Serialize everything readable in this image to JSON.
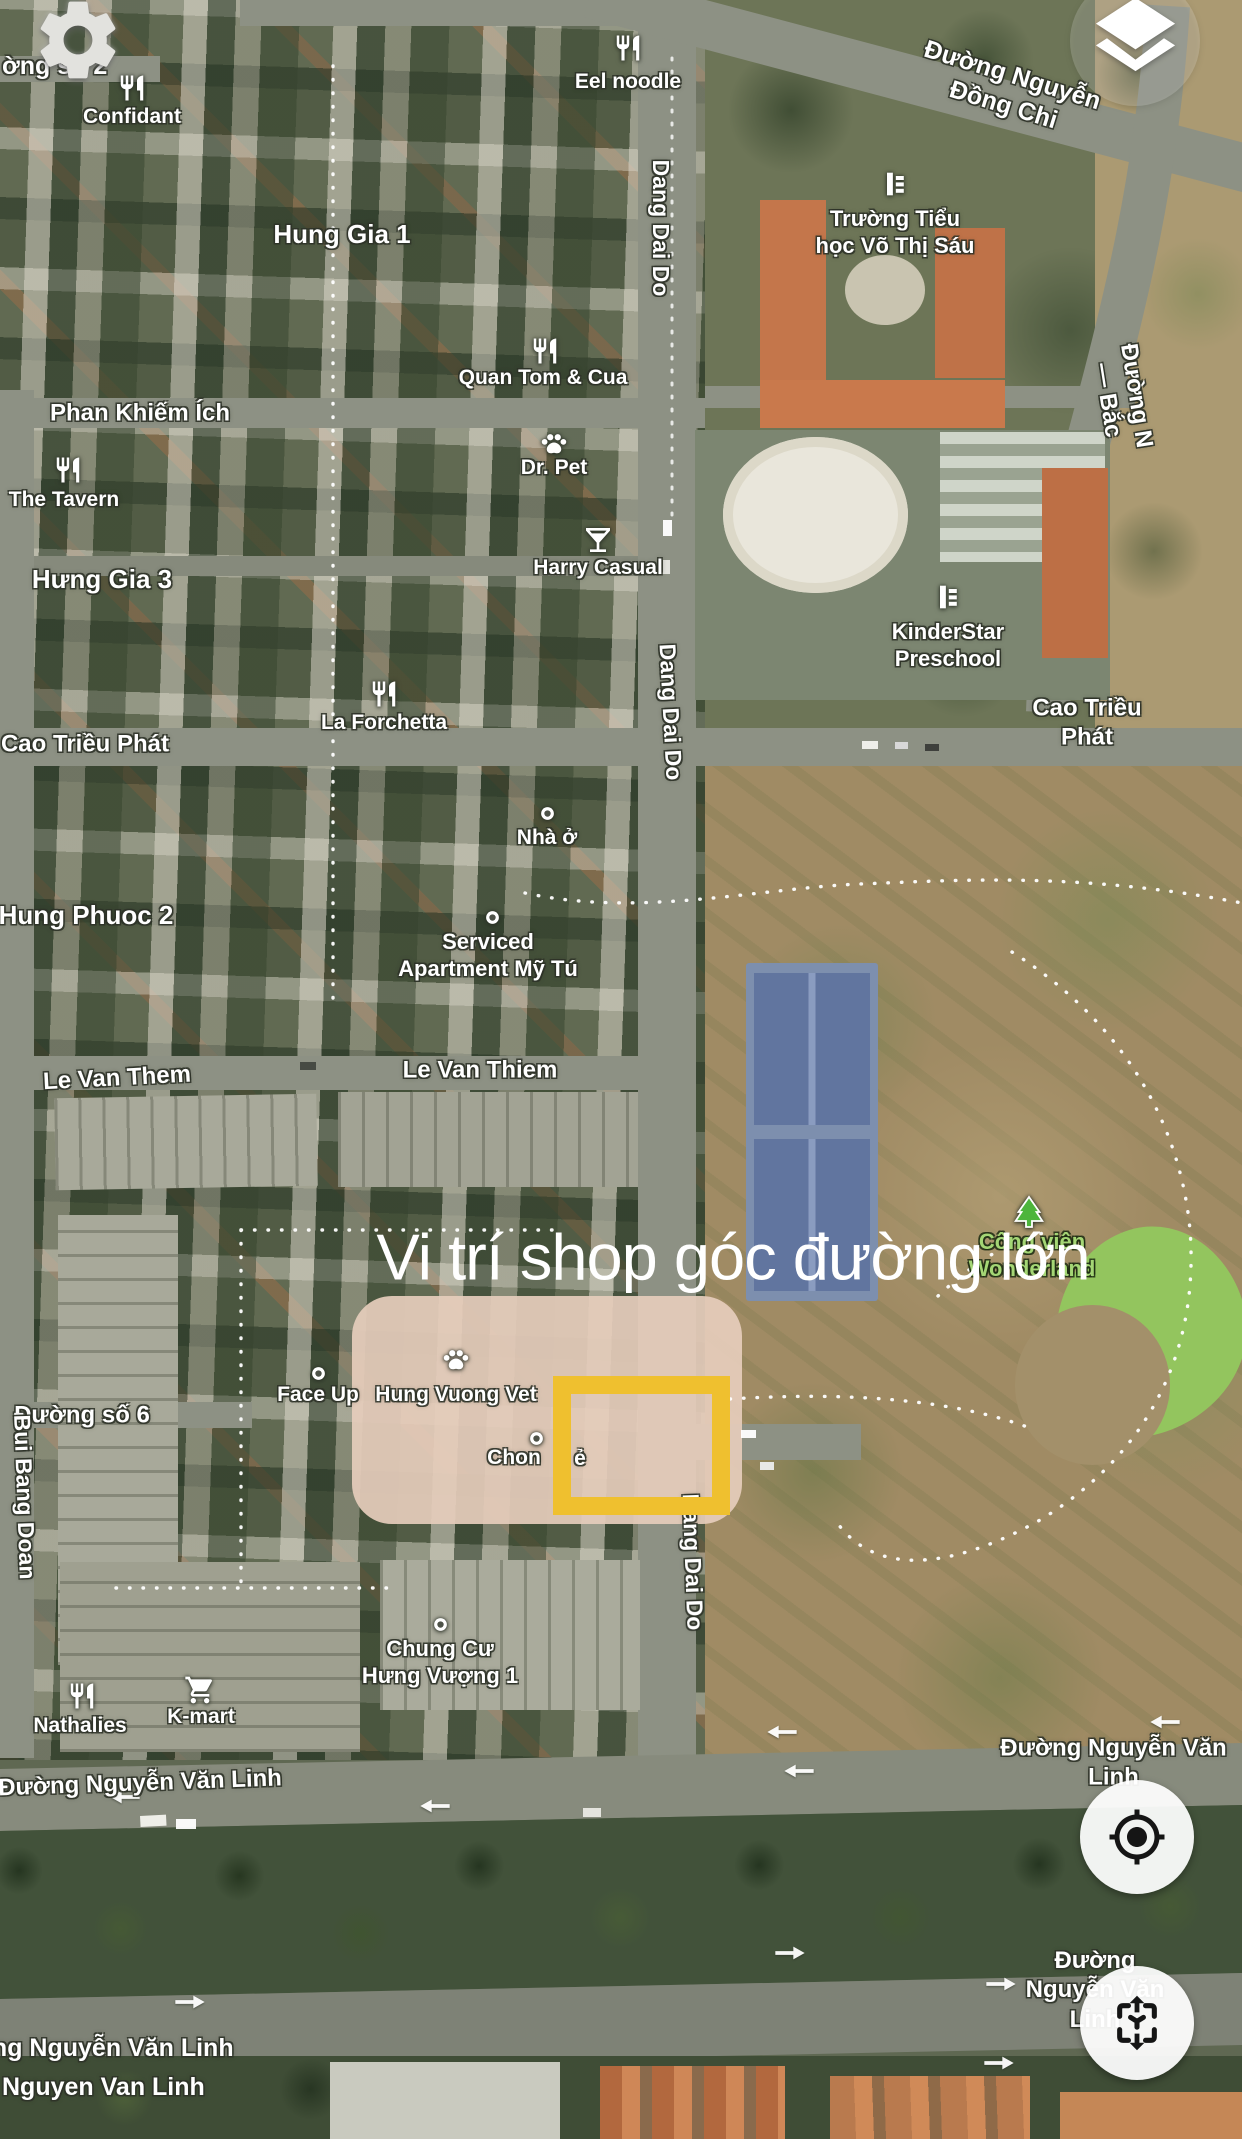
{
  "app": {
    "kind": "mobile-satellite-map"
  },
  "annotation": {
    "headline": "Vi trí shop góc đường lớn",
    "highlight_box_color": "#efc02f"
  },
  "controls": [
    {
      "name": "settings-button",
      "icon": "gear-icon"
    },
    {
      "name": "layers-button",
      "icon": "layers-icon"
    },
    {
      "name": "my-location-button",
      "icon": "locate-icon"
    },
    {
      "name": "spatial-view-button",
      "icon": "spatial-icon"
    }
  ],
  "colors": {
    "highlight": "#efc02f",
    "label_text": "#ffffff",
    "park_label_text": "#a4d675",
    "road": "#8d9184",
    "tennis_court": "#61759f",
    "park_lawn": "#93c55e"
  },
  "labels": [
    {
      "name": "street-duong-so-2",
      "kind": "street",
      "text": "ờng số 2",
      "x": 2,
      "y": 66,
      "size": 25,
      "ax": 0
    },
    {
      "name": "street-nguyen-dong-chi",
      "kind": "street",
      "text": "Đường Nguyễn Đồng Chi",
      "x": 1008,
      "y": 90,
      "rot": 17,
      "size": 25
    },
    {
      "name": "street-n-bac",
      "kind": "street",
      "text": "Đường N — Bắc",
      "x": 1122,
      "y": 398,
      "rot": 81,
      "size": 24
    },
    {
      "name": "street-dang-dai-do-top",
      "kind": "street",
      "text": "Dang Dai Do",
      "x": 661,
      "y": 228,
      "rot": 90,
      "size": 23
    },
    {
      "name": "street-dang-dai-do-mid",
      "kind": "street",
      "text": "Dang Dai Do",
      "x": 671,
      "y": 712,
      "rot": 87,
      "size": 23
    },
    {
      "name": "street-dang-dai-do-south",
      "kind": "street",
      "text": "Dang Dai Do",
      "x": 693,
      "y": 1562,
      "rot": 88,
      "size": 23
    },
    {
      "name": "street-phan-khiem-ich",
      "kind": "street",
      "text": "Phan Khiếm Ích",
      "x": 140,
      "y": 413,
      "size": 24
    },
    {
      "name": "street-cao-trieu-phat-west",
      "kind": "street",
      "text": "Cao Triều Phát",
      "x": 85,
      "y": 744,
      "size": 24
    },
    {
      "name": "street-cao-trieu-phat-east",
      "kind": "street",
      "text": "Cao Triều Phát",
      "x": 1087,
      "y": 723,
      "size": 24
    },
    {
      "name": "street-le-van-them",
      "kind": "street",
      "text": "Le Van Them",
      "x": 117,
      "y": 1078,
      "rot": -3,
      "size": 24
    },
    {
      "name": "street-le-van-thiem",
      "kind": "street",
      "text": "Le Van Thiem",
      "x": 480,
      "y": 1070,
      "size": 24
    },
    {
      "name": "street-duong-so-6",
      "kind": "street",
      "text": "Đường số 6",
      "x": 82,
      "y": 1415,
      "size": 24
    },
    {
      "name": "street-bui-bang-doan",
      "kind": "street",
      "text": "Bui Bang Doan",
      "x": 25,
      "y": 1497,
      "rot": 88,
      "size": 23
    },
    {
      "name": "street-nguyen-van-linh-west",
      "kind": "street",
      "text": "Đường Nguyễn Văn Linh",
      "x": 140,
      "y": 1783,
      "rot": -2,
      "size": 24
    },
    {
      "name": "street-nguyen-van-linh-east",
      "kind": "street",
      "text": "Đường Nguyễn Văn Linh",
      "x": 985,
      "y": 1763,
      "size": 24,
      "ax": 0
    },
    {
      "name": "street-nguyen-van-linh-southeast",
      "kind": "street",
      "text": "Đường Nguyễn Văn Linh",
      "x": 1095,
      "y": 1990,
      "size": 24
    },
    {
      "name": "street-nguyen-van-linh-southwest",
      "kind": "street",
      "text": "Đường Nguyễn Văn Linh",
      "x": -62,
      "y": 2048,
      "size": 25,
      "ax": 0
    },
    {
      "name": "street-nguyen-van-linh-plain",
      "kind": "street",
      "text": "Nguyen Van Linh",
      "x": 2,
      "y": 2087,
      "size": 25,
      "ax": 0
    },
    {
      "name": "area-hung-gia-1",
      "kind": "area",
      "text": "Hung Gia 1",
      "x": 342,
      "y": 235,
      "size": 26
    },
    {
      "name": "area-hung-gia-3",
      "kind": "area",
      "text": "Hưng Gia 3",
      "x": 102,
      "y": 580,
      "size": 26
    },
    {
      "name": "area-hung-phuoc-2",
      "kind": "area",
      "text": "Hung Phuoc 2",
      "x": 86,
      "y": 916,
      "size": 26
    },
    {
      "name": "poi-confidant",
      "kind": "poi",
      "text": "Confidant",
      "x": 132,
      "y": 117,
      "size": 21
    },
    {
      "name": "poi-eel-noodle",
      "kind": "poi",
      "text": "Eel noodle",
      "x": 628,
      "y": 82,
      "size": 21
    },
    {
      "name": "poi-truong-tieu-hoc-vo-thi-sau",
      "kind": "poi",
      "text": "Trường Tiểu\nhọc Võ Thị Sáu",
      "x": 895,
      "y": 233,
      "size": 22
    },
    {
      "name": "poi-quan-tom-cua",
      "kind": "poi",
      "text": "Quan Tom & Cua",
      "x": 543,
      "y": 378,
      "size": 21
    },
    {
      "name": "poi-dr-pet",
      "kind": "poi",
      "text": "Dr. Pet",
      "x": 554,
      "y": 468,
      "size": 21
    },
    {
      "name": "poi-the-tavern",
      "kind": "poi",
      "text": "The Tavern",
      "x": 64,
      "y": 500,
      "size": 21
    },
    {
      "name": "poi-harry-casual",
      "kind": "poi",
      "text": "Harry Casual",
      "x": 598,
      "y": 568,
      "size": 21
    },
    {
      "name": "poi-kinderstar-preschool",
      "kind": "poi",
      "text": "KinderStar\nPreschool",
      "x": 948,
      "y": 646,
      "size": 22
    },
    {
      "name": "poi-la-forchetta",
      "kind": "poi",
      "text": "La Forchetta",
      "x": 384,
      "y": 723,
      "size": 21
    },
    {
      "name": "poi-nha-o",
      "kind": "poi",
      "text": "Nhà ở",
      "x": 547,
      "y": 838,
      "size": 21
    },
    {
      "name": "poi-serviced-apartment-my-tu",
      "kind": "poi",
      "text": "Serviced\nApartment Mỹ Tú",
      "x": 488,
      "y": 956,
      "size": 22
    },
    {
      "name": "poi-face-up",
      "kind": "poi",
      "text": "Face Up",
      "x": 318,
      "y": 1395,
      "size": 21
    },
    {
      "name": "poi-hung-vuong-vet",
      "kind": "poi",
      "text": "Hung Vuong Vet",
      "x": 456,
      "y": 1395,
      "size": 21
    },
    {
      "name": "poi-chon",
      "kind": "poi",
      "text": "Chon",
      "x": 514,
      "y": 1458,
      "size": 21
    },
    {
      "name": "poi-chon-fragment",
      "kind": "poi",
      "text": "ẻ",
      "x": 580,
      "y": 1459,
      "size": 21
    },
    {
      "name": "poi-chung-cu-hung-vuong-1",
      "kind": "poi",
      "text": "Chung Cư\nHưng Vượng 1",
      "x": 440,
      "y": 1663,
      "size": 22
    },
    {
      "name": "poi-nathalies",
      "kind": "poi",
      "text": "Nathalies",
      "x": 80,
      "y": 1726,
      "size": 21
    },
    {
      "name": "poi-k-mart",
      "kind": "poi",
      "text": "K-mart",
      "x": 201,
      "y": 1717,
      "size": 21
    },
    {
      "name": "poi-cong-vien-wonderland",
      "kind": "park",
      "text": "Công viên\nWonderland",
      "x": 1032,
      "y": 1256,
      "size": 22
    }
  ],
  "icons": [
    {
      "name": "restaurant-icon",
      "glyph": "i-fork",
      "x": 132,
      "y": 88,
      "size": 30
    },
    {
      "name": "restaurant-icon",
      "glyph": "i-fork",
      "x": 628,
      "y": 48,
      "size": 30
    },
    {
      "name": "restaurant-icon",
      "glyph": "i-fork",
      "x": 68,
      "y": 470,
      "size": 30
    },
    {
      "name": "restaurant-icon",
      "glyph": "i-fork",
      "x": 545,
      "y": 351,
      "size": 30
    },
    {
      "name": "restaurant-icon",
      "glyph": "i-fork",
      "x": 384,
      "y": 694,
      "size": 30
    },
    {
      "name": "restaurant-icon",
      "glyph": "i-fork",
      "x": 82,
      "y": 1696,
      "size": 30
    },
    {
      "name": "pet-paw-icon",
      "glyph": "i-paw",
      "x": 554,
      "y": 445,
      "size": 30
    },
    {
      "name": "pet-paw-icon",
      "glyph": "i-paw",
      "x": 456,
      "y": 1361,
      "size": 30
    },
    {
      "name": "bar-martini-icon",
      "glyph": "i-martini",
      "x": 598,
      "y": 540,
      "size": 32
    },
    {
      "name": "school-icon",
      "glyph": "i-school",
      "x": 895,
      "y": 184,
      "size": 32
    },
    {
      "name": "school-icon",
      "glyph": "i-school",
      "x": 948,
      "y": 597,
      "size": 32
    },
    {
      "name": "shopping-cart-icon",
      "glyph": "i-cart",
      "x": 200,
      "y": 1690,
      "size": 32
    },
    {
      "name": "poi-dot-icon",
      "glyph": "i-dot",
      "x": 547,
      "y": 813,
      "size": 17
    },
    {
      "name": "poi-dot-icon",
      "glyph": "i-dot",
      "x": 492,
      "y": 917,
      "size": 17
    },
    {
      "name": "poi-dot-icon",
      "glyph": "i-dot",
      "x": 318,
      "y": 1373,
      "size": 17
    },
    {
      "name": "poi-dot-icon",
      "glyph": "i-dot",
      "x": 536,
      "y": 1438,
      "size": 17
    },
    {
      "name": "poi-dot-icon",
      "glyph": "i-dot",
      "x": 440,
      "y": 1624,
      "size": 17
    },
    {
      "name": "park-tree-icon",
      "glyph": "i-tree",
      "x": 1029,
      "y": 1212,
      "size": 36
    }
  ],
  "arrows": [
    {
      "dir": "left",
      "x": 125,
      "y": 1797
    },
    {
      "dir": "left",
      "x": 435,
      "y": 1806
    },
    {
      "dir": "left",
      "x": 782,
      "y": 1732
    },
    {
      "dir": "left",
      "x": 799,
      "y": 1771
    },
    {
      "dir": "left",
      "x": 1165,
      "y": 1722
    },
    {
      "dir": "right",
      "x": 190,
      "y": 2002
    },
    {
      "dir": "right",
      "x": 790,
      "y": 1953
    },
    {
      "dir": "right",
      "x": 1001,
      "y": 1984
    },
    {
      "dir": "right",
      "x": 999,
      "y": 2063
    }
  ]
}
